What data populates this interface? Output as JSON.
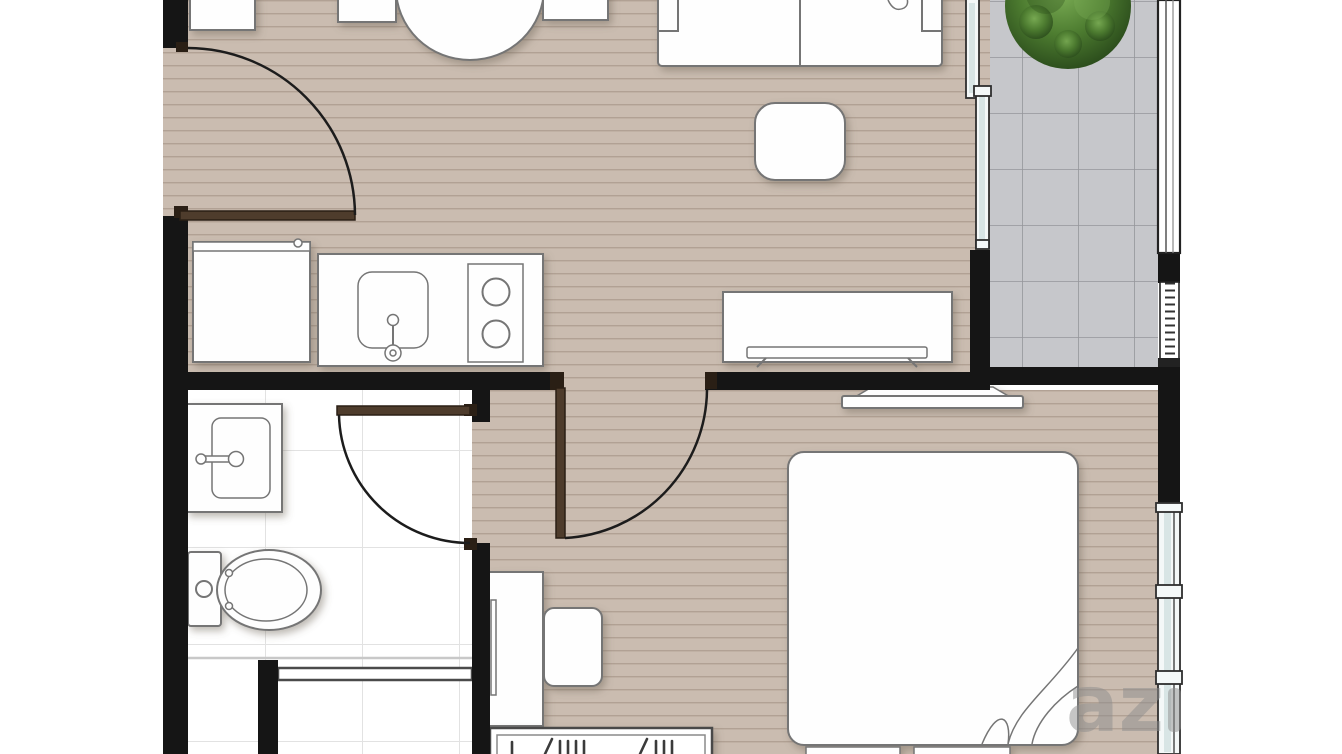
{
  "plan": {
    "kind": "apartment-floor-plan",
    "rooms": [
      {
        "name": "living-dining-area",
        "floor": "wood-taupe"
      },
      {
        "name": "kitchen-nook",
        "floor": "wood-taupe"
      },
      {
        "name": "bathroom",
        "floor": "white-tile"
      },
      {
        "name": "bedroom",
        "floor": "wood-taupe"
      },
      {
        "name": "balcony",
        "floor": "gray-tile"
      }
    ],
    "fixtures": [
      "entrance-door",
      "storage-cabinet",
      "refrigerator",
      "kitchen-counter",
      "kitchen-sink",
      "two-burner-stove",
      "dining-table",
      "dining-chair-left",
      "dining-chair-right",
      "sofa",
      "coffee-table",
      "tv-console",
      "sliding-glass-door",
      "balcony-plant",
      "balcony-railing",
      "bedroom-door",
      "tv-shelf",
      "bed",
      "blanket-fold",
      "desk",
      "desk-chair",
      "wardrobe",
      "bathroom-door",
      "bathroom-sink",
      "toilet",
      "shower-partition",
      "bedroom-window"
    ]
  },
  "watermark": {
    "text": "az"
  },
  "colors": {
    "floor": "#cabcb0",
    "floor_line": "#b1a194",
    "balcony_tile": "#c6c7cb",
    "balcony_tile_line": "#95969b",
    "bath": "#ffffff",
    "bath_line": "#e2e2e2",
    "wall": "#151515",
    "door": "#4e3c2c",
    "door_dark": "#2a1f15",
    "glass": "#d8e5e5",
    "frame": "#2e2e2e",
    "outline": "#757575",
    "outline_dark": "#4a4a4a",
    "plant": "#4d7c30",
    "plant_dark": "#2d4f1d",
    "plant_light": "#7bad55",
    "watermark": "#8d8d8d"
  }
}
